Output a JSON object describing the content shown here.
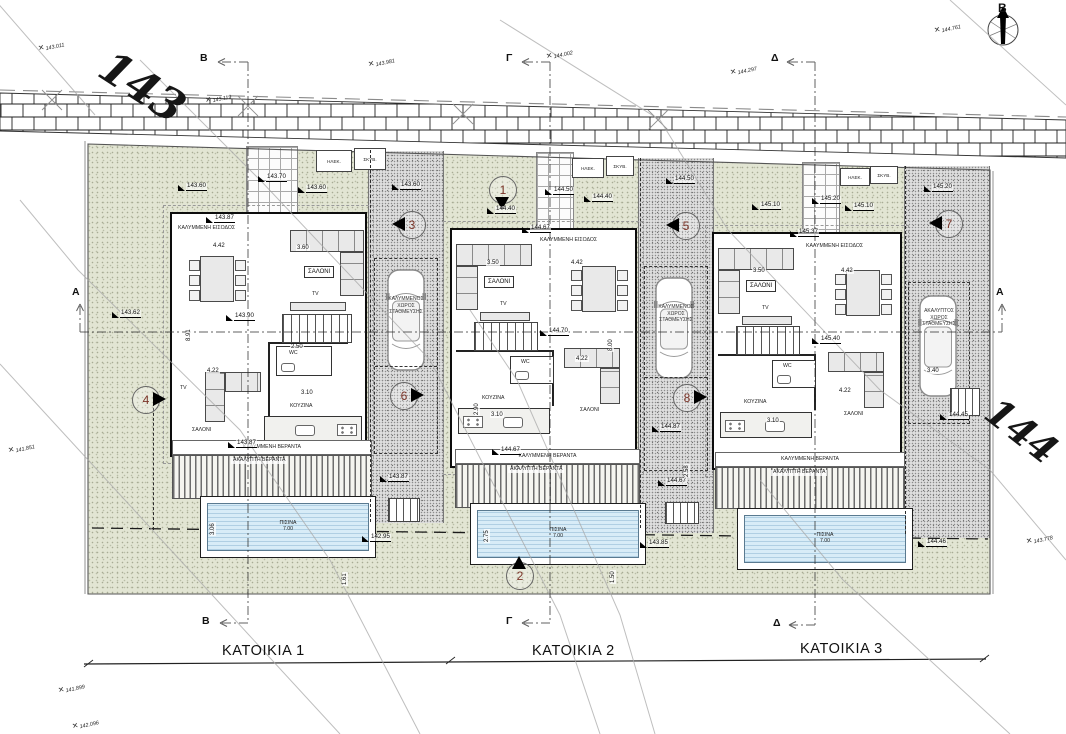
{
  "big_labels": {
    "road_top": "143",
    "road_right": "144"
  },
  "north": {
    "label": "B"
  },
  "titles": [
    "ΚΑΤΟΙΚΙΑ 1",
    "ΚΑΤΟΙΚΙΑ 2",
    "ΚΑΤΟΙΚΙΑ 3"
  ],
  "sections": {
    "a": "A",
    "b": "B",
    "g": "Γ",
    "d": "Δ"
  },
  "markers": [
    "1",
    "2",
    "3",
    "4",
    "5",
    "6",
    "7",
    "8"
  ],
  "spots": [
    "143.011",
    "143.119",
    "143.981",
    "144.002",
    "144.297",
    "144.761",
    "141.851",
    "143.778",
    "141.899",
    "142.096"
  ],
  "utilities": [
    "ΗΛΕΚ.",
    "ΣΚΥΒ."
  ],
  "houses": [
    {
      "entrance": "ΚΑΛΥΜΜΕΝΗ ΕΙΣΟΔΟΣ",
      "salon": "ΣΑΛΟΝΙ",
      "salon2": "ΣΑΛΟΝΙ",
      "kitchen": "ΚΟΥΖΙΝΑ",
      "wc": "WC",
      "tv": "TV",
      "tv2": "TV",
      "veranda_cov": "ΚΑΛΥΜΜΕΝΗ ΒΕΡΑΝΤΑ",
      "veranda_open": "ΑΚΑΛΥΠΤΗ ΒΕΡΑΝΤΑ",
      "pool": "ΠΙΣΙΝΑ",
      "pool_len": "7.00",
      "parking": [
        "ΚΑΛΥΜΜΕΝΟΣ",
        "ΧΩΡΟΣ",
        "ΣΤΑΘΜΕΥΣΗΣ"
      ]
    },
    {
      "entrance": "ΚΑΛΥΜΜΕΝΗ ΕΙΣΟΔΟΣ",
      "salon": "ΣΑΛΟΝΙ",
      "salon2": "ΣΑΛΟΝΙ",
      "kitchen": "ΚΟΥΖΙΝΑ",
      "wc": "WC",
      "tv": "TV",
      "veranda_cov": "ΚΑΛΥΜΜΕΝΗ ΒΕΡΑΝΤΑ",
      "veranda_open": "ΑΚΑΛΥΠΤΗ ΒΕΡΑΝΤΑ",
      "pool": "ΠΙΣΙΝΑ",
      "pool_len": "7.00",
      "parking": [
        "ΚΑΛΥΜΜΕΝΟΣ",
        "ΧΩΡΟΣ",
        "ΣΤΑΘΜΕΥΣΗΣ"
      ]
    },
    {
      "entrance": "ΚΑΛΥΜΜΕΝΗ ΕΙΣΟΔΟΣ",
      "salon": "ΣΑΛΟΝΙ",
      "salon2": "ΣΑΛΟΝΙ",
      "kitchen": "ΚΟΥΖΙΝΑ",
      "wc": "WC",
      "tv": "TV",
      "veranda_cov": "ΚΑΛΥΜΜΕΝΗ ΒΕΡΑΝΤΑ",
      "veranda_open": "ΑΚΑΛΥΠΤΗ ΒΕΡΑΝΤΑ",
      "pool": "ΠΙΣΙΝΑ",
      "pool_len": "7.00",
      "parking": [
        "ΑΚΑΛΥΠΤΟΣ",
        "ΧΩΡΟΣ",
        "ΣΤΑΘΜΕΥΣΗΣ"
      ]
    }
  ],
  "flags": [
    "143.60",
    "143.70",
    "143.60",
    "143.87",
    "143.90",
    "144.40",
    "144.50",
    "144.40",
    "144.50",
    "144.67",
    "144.70",
    "145.10",
    "145.20",
    "145.10",
    "145.20",
    "145.37",
    "145.40",
    "143.62",
    "143.87",
    "143.87",
    "142.95",
    "144.67",
    "144.67",
    "143.85",
    "144.87",
    "144.45",
    "144.46",
    "143.60"
  ],
  "dims": [
    "4.42",
    "3.60",
    "4.22",
    "3.10",
    "2.50",
    "3.06",
    "1.61",
    "3.50",
    "4.42",
    "4.22",
    "3.10",
    "2.90",
    "2.75",
    "1.50",
    "8.00",
    "8.91",
    "3.50",
    "4.42",
    "4.22",
    "3.10",
    "3.40",
    "2.58"
  ]
}
